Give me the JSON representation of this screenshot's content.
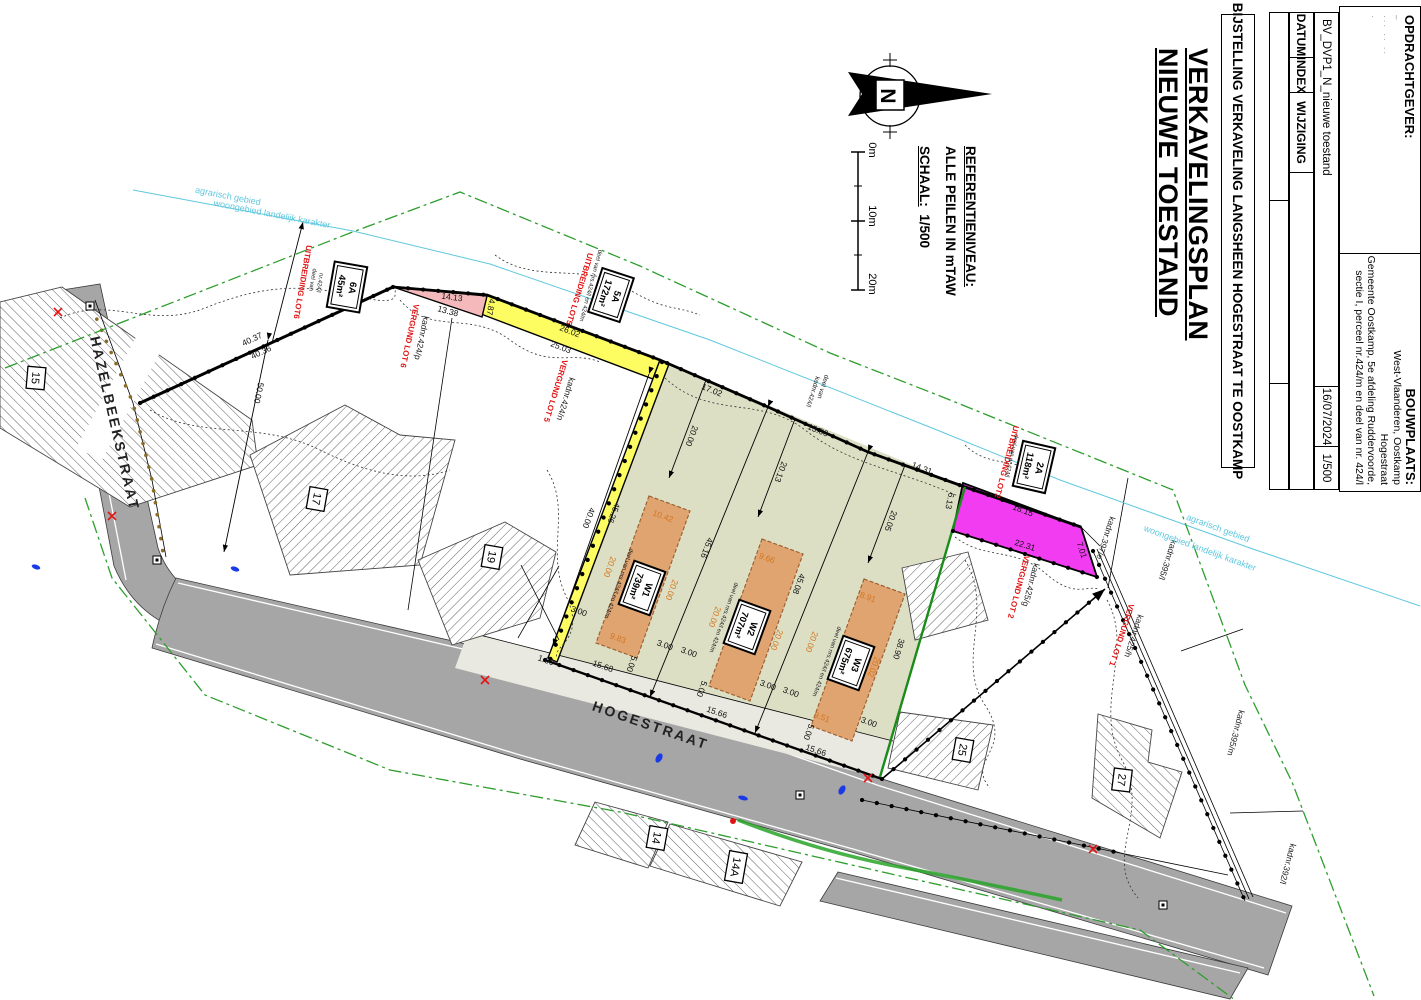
{
  "sheet": {
    "width": 1421,
    "height": 1000
  },
  "title_block": {
    "main_title_line1": "VERKAVELINGSPLAN",
    "main_title_line2": "NIEUWE TOESTAND",
    "subtitle": "BIJSTELLING VERKAVELING LANGSHEEN HOGESTRAAT TE OOSTKAMP",
    "rev_table": {
      "col1": "DATUM",
      "col2": "INDEX",
      "col3": "WIJZIGING",
      "entry": "BV_DVP1_N_nieuwe toestand",
      "date": "16/07/2024",
      "scale": "1/500"
    },
    "client": {
      "header": "OPDRACHTGEVER:",
      "redaction_marks": [
        "–",
        "··· ·· ··",
        "·"
      ]
    },
    "site": {
      "header": "BOUWPLAATS:",
      "lines": [
        "West-Vlaanderen, Oostkamp",
        "Hogestraat",
        "Gemeente Oostkamp, 5e afdeling Ruddervoorde,",
        "sectie I, perceel nr.424/m en deel van nr. 424/l"
      ]
    }
  },
  "legend": {
    "reference_header": "REFERENTIENIVEAU:",
    "reference_text": "ALLE PEILEN IN mTAW",
    "scale_word": "SCHAAL:",
    "scale_value": "1/500",
    "north_letter": "N",
    "scalebar_ticks": [
      "0m",
      "10m",
      "20m"
    ]
  },
  "colors": {
    "road": "#a6a6a6",
    "lot_olive": "#dcdfc4",
    "strip": "#e9e9e1",
    "yellow": "#fdfd62",
    "pink": "#f5b9bb",
    "magenta": "#f23cf2",
    "building": "#e0a470",
    "boundary_green": "#1a8c1a",
    "zone_green": "#2e9e2e",
    "cyan": "#5fc8de",
    "red": "#e11414",
    "orange_dim": "#d4761f"
  },
  "lot_tags": [
    {
      "id": "W1",
      "area": "739m²",
      "x": 642,
      "y": 588,
      "r": 110
    },
    {
      "id": "W2",
      "area": "707m²",
      "x": 747,
      "y": 627,
      "r": 110
    },
    {
      "id": "W3",
      "area": "675m²",
      "x": 851,
      "y": 663,
      "r": 110
    },
    {
      "id": "6A",
      "area": "45m²",
      "x": 347,
      "y": 287,
      "r": 100
    },
    {
      "id": "5A",
      "area": "172m²",
      "x": 611,
      "y": 295,
      "r": 108
    },
    {
      "id": "2A",
      "area": "118m²",
      "x": 1034,
      "y": 467,
      "r": 103
    }
  ],
  "parcel_tags": [
    {
      "t": "15",
      "x": 36,
      "y": 378,
      "r": 95
    },
    {
      "t": "17",
      "x": 317,
      "y": 499,
      "r": 100
    },
    {
      "t": "19",
      "x": 492,
      "y": 557,
      "r": 100
    },
    {
      "t": "25",
      "x": 963,
      "y": 750,
      "r": 100
    },
    {
      "t": "27",
      "x": 1122,
      "y": 780,
      "r": 97
    },
    {
      "t": "14",
      "x": 657,
      "y": 838,
      "r": 100
    },
    {
      "t": "14A",
      "x": 736,
      "y": 867,
      "r": 100
    }
  ],
  "plan_labels": [
    {
      "t": "40.37",
      "x": 252,
      "y": 339,
      "r": -25,
      "c": "dim",
      "n": "dim-40-37"
    },
    {
      "t": "40.36",
      "x": 261,
      "y": 352,
      "r": -25,
      "c": "dim",
      "n": "dim-40-36"
    },
    {
      "t": "50.00",
      "x": 259,
      "y": 393,
      "r": 102,
      "c": "dim",
      "n": "dim-50-00"
    },
    {
      "t": "14.13",
      "x": 452,
      "y": 297,
      "r": 7,
      "c": "dim",
      "n": "dim-14-13"
    },
    {
      "t": "13.38",
      "x": 448,
      "y": 311,
      "r": 15,
      "c": "dim",
      "n": "dim-13-38"
    },
    {
      "t": "4.87",
      "x": 491,
      "y": 307,
      "r": 100,
      "c": "dim",
      "n": "dim-4-87"
    },
    {
      "t": "26.02",
      "x": 570,
      "y": 331,
      "r": 21,
      "c": "dim",
      "n": "dim-26-02"
    },
    {
      "t": "25.03",
      "x": 561,
      "y": 347,
      "r": 21,
      "c": "dim",
      "n": "dim-25-03"
    },
    {
      "t": "17.02",
      "x": 712,
      "y": 390,
      "r": 22,
      "c": "dim",
      "n": "dim-17-02"
    },
    {
      "t": "15.66",
      "x": 818,
      "y": 430,
      "r": 22,
      "c": "dim",
      "n": "dim-15-66-top"
    },
    {
      "t": "14.31",
      "x": 922,
      "y": 468,
      "r": 21,
      "c": "dim",
      "n": "dim-14-31"
    },
    {
      "t": "20.00",
      "x": 692,
      "y": 436,
      "r": 110,
      "c": "dim",
      "n": "dim-20-00-w1"
    },
    {
      "t": "20.13",
      "x": 781,
      "y": 472,
      "r": 110,
      "c": "dim",
      "n": "dim-20-13"
    },
    {
      "t": "20.05",
      "x": 891,
      "y": 521,
      "r": 110,
      "c": "dim",
      "n": "dim-20-05"
    },
    {
      "t": "45.16",
      "x": 707,
      "y": 548,
      "r": 110,
      "c": "dim",
      "n": "dim-45-16"
    },
    {
      "t": "45.08",
      "x": 799,
      "y": 584,
      "r": 110,
      "c": "dim",
      "n": "dim-45-08"
    },
    {
      "t": "38.90",
      "x": 899,
      "y": 649,
      "r": 107,
      "c": "dim",
      "n": "dim-38-90"
    },
    {
      "t": "45.26",
      "x": 614,
      "y": 513,
      "r": 110,
      "c": "dim",
      "n": "dim-45-26"
    },
    {
      "t": "40.00",
      "x": 589,
      "y": 518,
      "r": 110,
      "c": "dim",
      "n": "dim-40-00"
    },
    {
      "t": "3.00",
      "x": 579,
      "y": 611,
      "r": 20,
      "c": "dim",
      "n": "dim-3-00"
    },
    {
      "t": "3.00",
      "x": 665,
      "y": 645,
      "r": 20,
      "c": "dim",
      "n": "dim-3-00"
    },
    {
      "t": "3.00",
      "x": 689,
      "y": 652,
      "r": 20,
      "c": "dim",
      "n": "dim-3-00"
    },
    {
      "t": "3.00",
      "x": 768,
      "y": 685,
      "r": 20,
      "c": "dim",
      "n": "dim-3-00"
    },
    {
      "t": "3.00",
      "x": 791,
      "y": 692,
      "r": 20,
      "c": "dim",
      "n": "dim-3-00"
    },
    {
      "t": "3.00",
      "x": 869,
      "y": 722,
      "r": 20,
      "c": "dim",
      "n": "dim-3-00"
    },
    {
      "t": "5.00",
      "x": 632,
      "y": 664,
      "r": 110,
      "c": "dim",
      "n": "dim-5-00"
    },
    {
      "t": "5.00",
      "x": 702,
      "y": 689,
      "r": 110,
      "c": "dim",
      "n": "dim-5-00"
    },
    {
      "t": "5.00",
      "x": 809,
      "y": 732,
      "r": 110,
      "c": "dim",
      "n": "dim-5-00"
    },
    {
      "t": "15.68",
      "x": 603,
      "y": 666,
      "r": 19,
      "c": "dim",
      "n": "dim-15-68"
    },
    {
      "t": "15.66",
      "x": 717,
      "y": 712,
      "r": 19,
      "c": "dim",
      "n": "dim-15-66"
    },
    {
      "t": "15.66",
      "x": 816,
      "y": 750,
      "r": 19,
      "c": "dim",
      "n": "dim-15-66"
    },
    {
      "t": "1.00",
      "x": 546,
      "y": 660,
      "r": 19,
      "c": "dim",
      "n": "dim-1-00"
    },
    {
      "t": "6.13",
      "x": 950,
      "y": 501,
      "r": 102,
      "c": "dim",
      "n": "dim-6-13"
    },
    {
      "t": "18.15",
      "x": 1023,
      "y": 510,
      "r": 20,
      "c": "dim",
      "n": "dim-18-15"
    },
    {
      "t": "22.31",
      "x": 1025,
      "y": 545,
      "r": 17,
      "c": "dim",
      "n": "dim-22-31"
    },
    {
      "t": "7.01",
      "x": 1082,
      "y": 550,
      "r": 72,
      "c": "dim",
      "n": "dim-7-01"
    },
    {
      "t": "10.42",
      "x": 663,
      "y": 516,
      "r": 20,
      "c": "dimo",
      "n": "bdim-10-42"
    },
    {
      "t": "9.66",
      "x": 767,
      "y": 558,
      "r": 20,
      "c": "dimo",
      "n": "bdim-9-66"
    },
    {
      "t": "8.91",
      "x": 868,
      "y": 597,
      "r": 20,
      "c": "dimo",
      "n": "bdim-8-91"
    },
    {
      "t": "9.83",
      "x": 618,
      "y": 638,
      "r": 20,
      "c": "dimo",
      "n": "bdim-9-83"
    },
    {
      "t": "9.51",
      "x": 822,
      "y": 717,
      "r": 20,
      "c": "dimo",
      "n": "bdim-9-51"
    },
    {
      "t": "20.00",
      "x": 610,
      "y": 567,
      "r": 110,
      "c": "dimo",
      "n": "bdim-20-00"
    },
    {
      "t": "20.00",
      "x": 672,
      "y": 590,
      "r": 110,
      "c": "dimo",
      "n": "bdim-20-00"
    },
    {
      "t": "20.00",
      "x": 715,
      "y": 617,
      "r": 110,
      "c": "dimo",
      "n": "bdim-20-00"
    },
    {
      "t": "20.00",
      "x": 777,
      "y": 640,
      "r": 110,
      "c": "dimo",
      "n": "bdim-20-00"
    },
    {
      "t": "20.00",
      "x": 812,
      "y": 642,
      "r": 110,
      "c": "dimo",
      "n": "bdim-20-00"
    },
    {
      "t": "20.02",
      "x": 874,
      "y": 667,
      "r": 110,
      "c": "dimo",
      "n": "bdim-20-02"
    },
    {
      "t": "UITBREIDING LOT6",
      "x": 303,
      "y": 282,
      "r": 100,
      "c": "red",
      "n": "label-uitbreiding-lot6"
    },
    {
      "t": "VERGUND LOT 6",
      "x": 410,
      "y": 336,
      "r": 102,
      "c": "red",
      "n": "label-vergund-lot6"
    },
    {
      "t": "UITBREIDING LOT5",
      "x": 580,
      "y": 289,
      "r": 107,
      "c": "red",
      "n": "label-uitbreiding-lot5"
    },
    {
      "t": "VERGUND LOT 5",
      "x": 556,
      "y": 391,
      "r": 107,
      "c": "red",
      "n": "label-vergund-lot5"
    },
    {
      "t": "UITBREIDING LOT2",
      "x": 1007,
      "y": 462,
      "r": 105,
      "c": "red",
      "n": "label-uitbreiding-lot2"
    },
    {
      "t": "VERGUND LOT 2",
      "x": 1019,
      "y": 587,
      "r": 105,
      "c": "red",
      "n": "label-vergund-lot2"
    },
    {
      "t": "VERGUND LOT 1",
      "x": 1122,
      "y": 635,
      "r": 108,
      "c": "red",
      "n": "label-vergund-lot1"
    },
    {
      "t": "kadnr.424/p",
      "x": 422,
      "y": 338,
      "r": 102,
      "c": "kad",
      "n": "kadnr-424p"
    },
    {
      "t": "kadnr.424/n",
      "x": 566,
      "y": 399,
      "r": 107,
      "c": "kad",
      "n": "kadnr-424n"
    },
    {
      "t": "kadnr.425/g",
      "x": 1031,
      "y": 585,
      "r": 105,
      "c": "kad",
      "n": "kadnr-425g"
    },
    {
      "t": "kadnr.425/h",
      "x": 1134,
      "y": 636,
      "r": 108,
      "c": "kad",
      "n": "kadnr-425h"
    },
    {
      "t": "kadnr.397/e",
      "x": 1106,
      "y": 538,
      "r": 108,
      "c": "kad",
      "n": "kadnr-397e"
    },
    {
      "t": "kadnr.395/l",
      "x": 1168,
      "y": 560,
      "r": 108,
      "c": "kad",
      "n": "kadnr-395l"
    },
    {
      "t": "kadnr.395/m",
      "x": 1236,
      "y": 733,
      "r": 105,
      "c": "kad",
      "n": "kadnr-395m"
    },
    {
      "t": "kadnr.392/l",
      "x": 1288,
      "y": 864,
      "r": 105,
      "c": "kad",
      "n": "kadnr-392l"
    },
    {
      "t": "deel van",
      "x": 824,
      "y": 387,
      "r": 108,
      "c": "tiny7",
      "n": "deel-van-kadnr-424l"
    },
    {
      "t": "kadnr.424/l",
      "x": 814,
      "y": 392,
      "r": 108,
      "c": "tiny7",
      "n": "deel-van-kadnr-424l"
    },
    {
      "t": "deel van",
      "x": 314,
      "y": 280,
      "r": 100,
      "c": "tiny",
      "n": "deel-van-nr424l"
    },
    {
      "t": "nr.424/l",
      "x": 321,
      "y": 283,
      "r": 100,
      "c": "tiny",
      "n": "deel-van-nr424l"
    },
    {
      "t": "deel van nr.424/l",
      "x": 1013,
      "y": 456,
      "r": 103,
      "c": "tiny",
      "n": "deel-van-nr424l"
    },
    {
      "t": "deel van nrs.424/l en 424/m",
      "x": 592,
      "y": 286,
      "r": 105,
      "c": "tiny",
      "n": "deel-van-nrs424"
    },
    {
      "t": "deel van nrs.424/l en 424/m",
      "x": 620,
      "y": 584,
      "r": 110,
      "c": "tiny",
      "n": "deel-van-nrs424"
    },
    {
      "t": "deel van nrs.424/l en 424/m",
      "x": 725,
      "y": 618,
      "r": 110,
      "c": "tiny",
      "n": "deel-van-nrs424"
    },
    {
      "t": "deel van nrs.424/l en 424/m",
      "x": 828,
      "y": 662,
      "r": 110,
      "c": "tiny",
      "n": "deel-van-nrs424"
    },
    {
      "t": "agrarisch gebied",
      "x": 228,
      "y": 196,
      "r": 11,
      "c": "cyan",
      "n": "zone-agrarisch-gebied"
    },
    {
      "t": "woongebied landelijk karakter",
      "x": 272,
      "y": 214,
      "r": 11,
      "c": "cyan",
      "n": "zone-woongebied"
    },
    {
      "t": "agrarisch gebied",
      "x": 1218,
      "y": 528,
      "r": 20,
      "c": "cyan",
      "n": "zone-agrarisch-gebied"
    },
    {
      "t": "woongebied landelijk karakter",
      "x": 1200,
      "y": 548,
      "r": 20,
      "c": "cyan",
      "n": "zone-woongebied"
    },
    {
      "t": "HAZELBEEKSTRAAT",
      "x": 113,
      "y": 424,
      "r": 77,
      "c": "street",
      "n": "street-hazelbeekstraat"
    },
    {
      "t": "HOGESTRAAT",
      "x": 650,
      "y": 727,
      "r": 19,
      "c": "street",
      "n": "street-hogestraat"
    },
    {
      "t": "0m",
      "x": 872,
      "y": 150,
      "r": 90,
      "c": "scale",
      "a": "start",
      "n": "scalebar-0m"
    },
    {
      "t": "10m",
      "x": 872,
      "y": 216,
      "r": 90,
      "c": "scale",
      "a": "start",
      "n": "scalebar-10m"
    },
    {
      "t": "20m",
      "x": 872,
      "y": 284,
      "r": 90,
      "c": "scale",
      "a": "start",
      "n": "scalebar-20m"
    },
    {
      "t": "N",
      "x": 884,
      "y": 96,
      "r": 90,
      "c": "north",
      "n": "north-letter"
    }
  ]
}
